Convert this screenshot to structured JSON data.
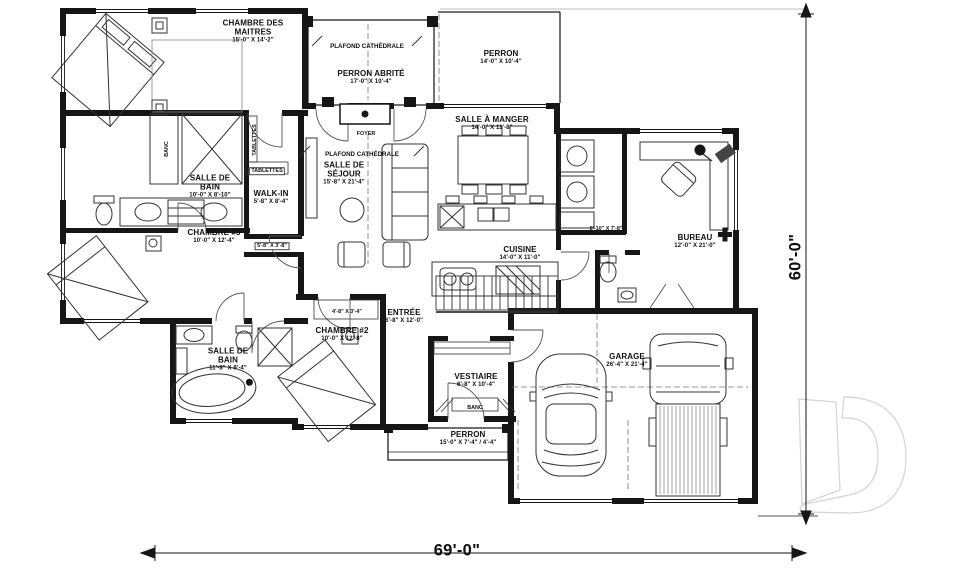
{
  "colors": {
    "wall": "#161616",
    "furniture_line": "#333333",
    "door_line": "#555555",
    "logo": "#d3d3d3"
  },
  "dimensions": {
    "width": "69'-0\"",
    "height": "60'-0\""
  },
  "watermark_letter": "D",
  "annotations": {
    "cathedral_ceiling": "PLAFOND CATHÉDRALE",
    "foyer": "FOYER",
    "banc": "BANC",
    "tablettes": "TABLETTES",
    "closet_a_dims": "5'-8\" X 3'-8\"",
    "closet_b_dims": "4'-8\" X 3'-4\"",
    "utility_dims": "8'-10\" X 7'-8\""
  },
  "rooms": {
    "master_bedroom": {
      "name": "CHAMBRE DES MAITRES",
      "dims": "15'-0\" X 14'-2\""
    },
    "covered_porch": {
      "name": "PERRON ABRITÉ",
      "dims": "17'-0\" X 10'-4\""
    },
    "porch_top": {
      "name": "PERRON",
      "dims": "14'-0\" X 10'-4\""
    },
    "dining_room": {
      "name": "SALLE À MANGER",
      "dims": "14'-0\" X 11'-8\""
    },
    "bathroom_1": {
      "name": "SALLE DE BAIN",
      "dims": "10'-0\" X 8'-10\""
    },
    "walk_in": {
      "name": "WALK-IN",
      "dims": "5'-8\" X 8'-4\""
    },
    "living_room": {
      "name": "SALLE DE SÉJOUR",
      "dims": "15'-8\" X 21'-4\""
    },
    "bedroom_3": {
      "name": "CHAMBRE #3",
      "dims": "10'-0\" X 12'-4\""
    },
    "kitchen": {
      "name": "CUISINE",
      "dims": "14'-0\" X 11'-0\""
    },
    "office": {
      "name": "BUREAU",
      "dims": "12'-0\" X 21'-0\""
    },
    "bedroom_2": {
      "name": "CHAMBRE #2",
      "dims": "10'-0\" X 12'-8\""
    },
    "entry": {
      "name": "ENTRÉE",
      "dims": "6'-8\" X 12'-0\""
    },
    "bathroom_2": {
      "name": "SALLE DE BAIN",
      "dims": "11'-8\" X 9'-4\""
    },
    "mudroom": {
      "name": "VESTIAIRE",
      "dims": "6'-8\" X 10'-4\""
    },
    "porch_bottom": {
      "name": "PERRON",
      "dims": "15'-0\" X 7'-4\" / 4'-4\""
    },
    "garage": {
      "name": "GARAGE",
      "dims": "26'-4\" X 21'-4\""
    }
  }
}
